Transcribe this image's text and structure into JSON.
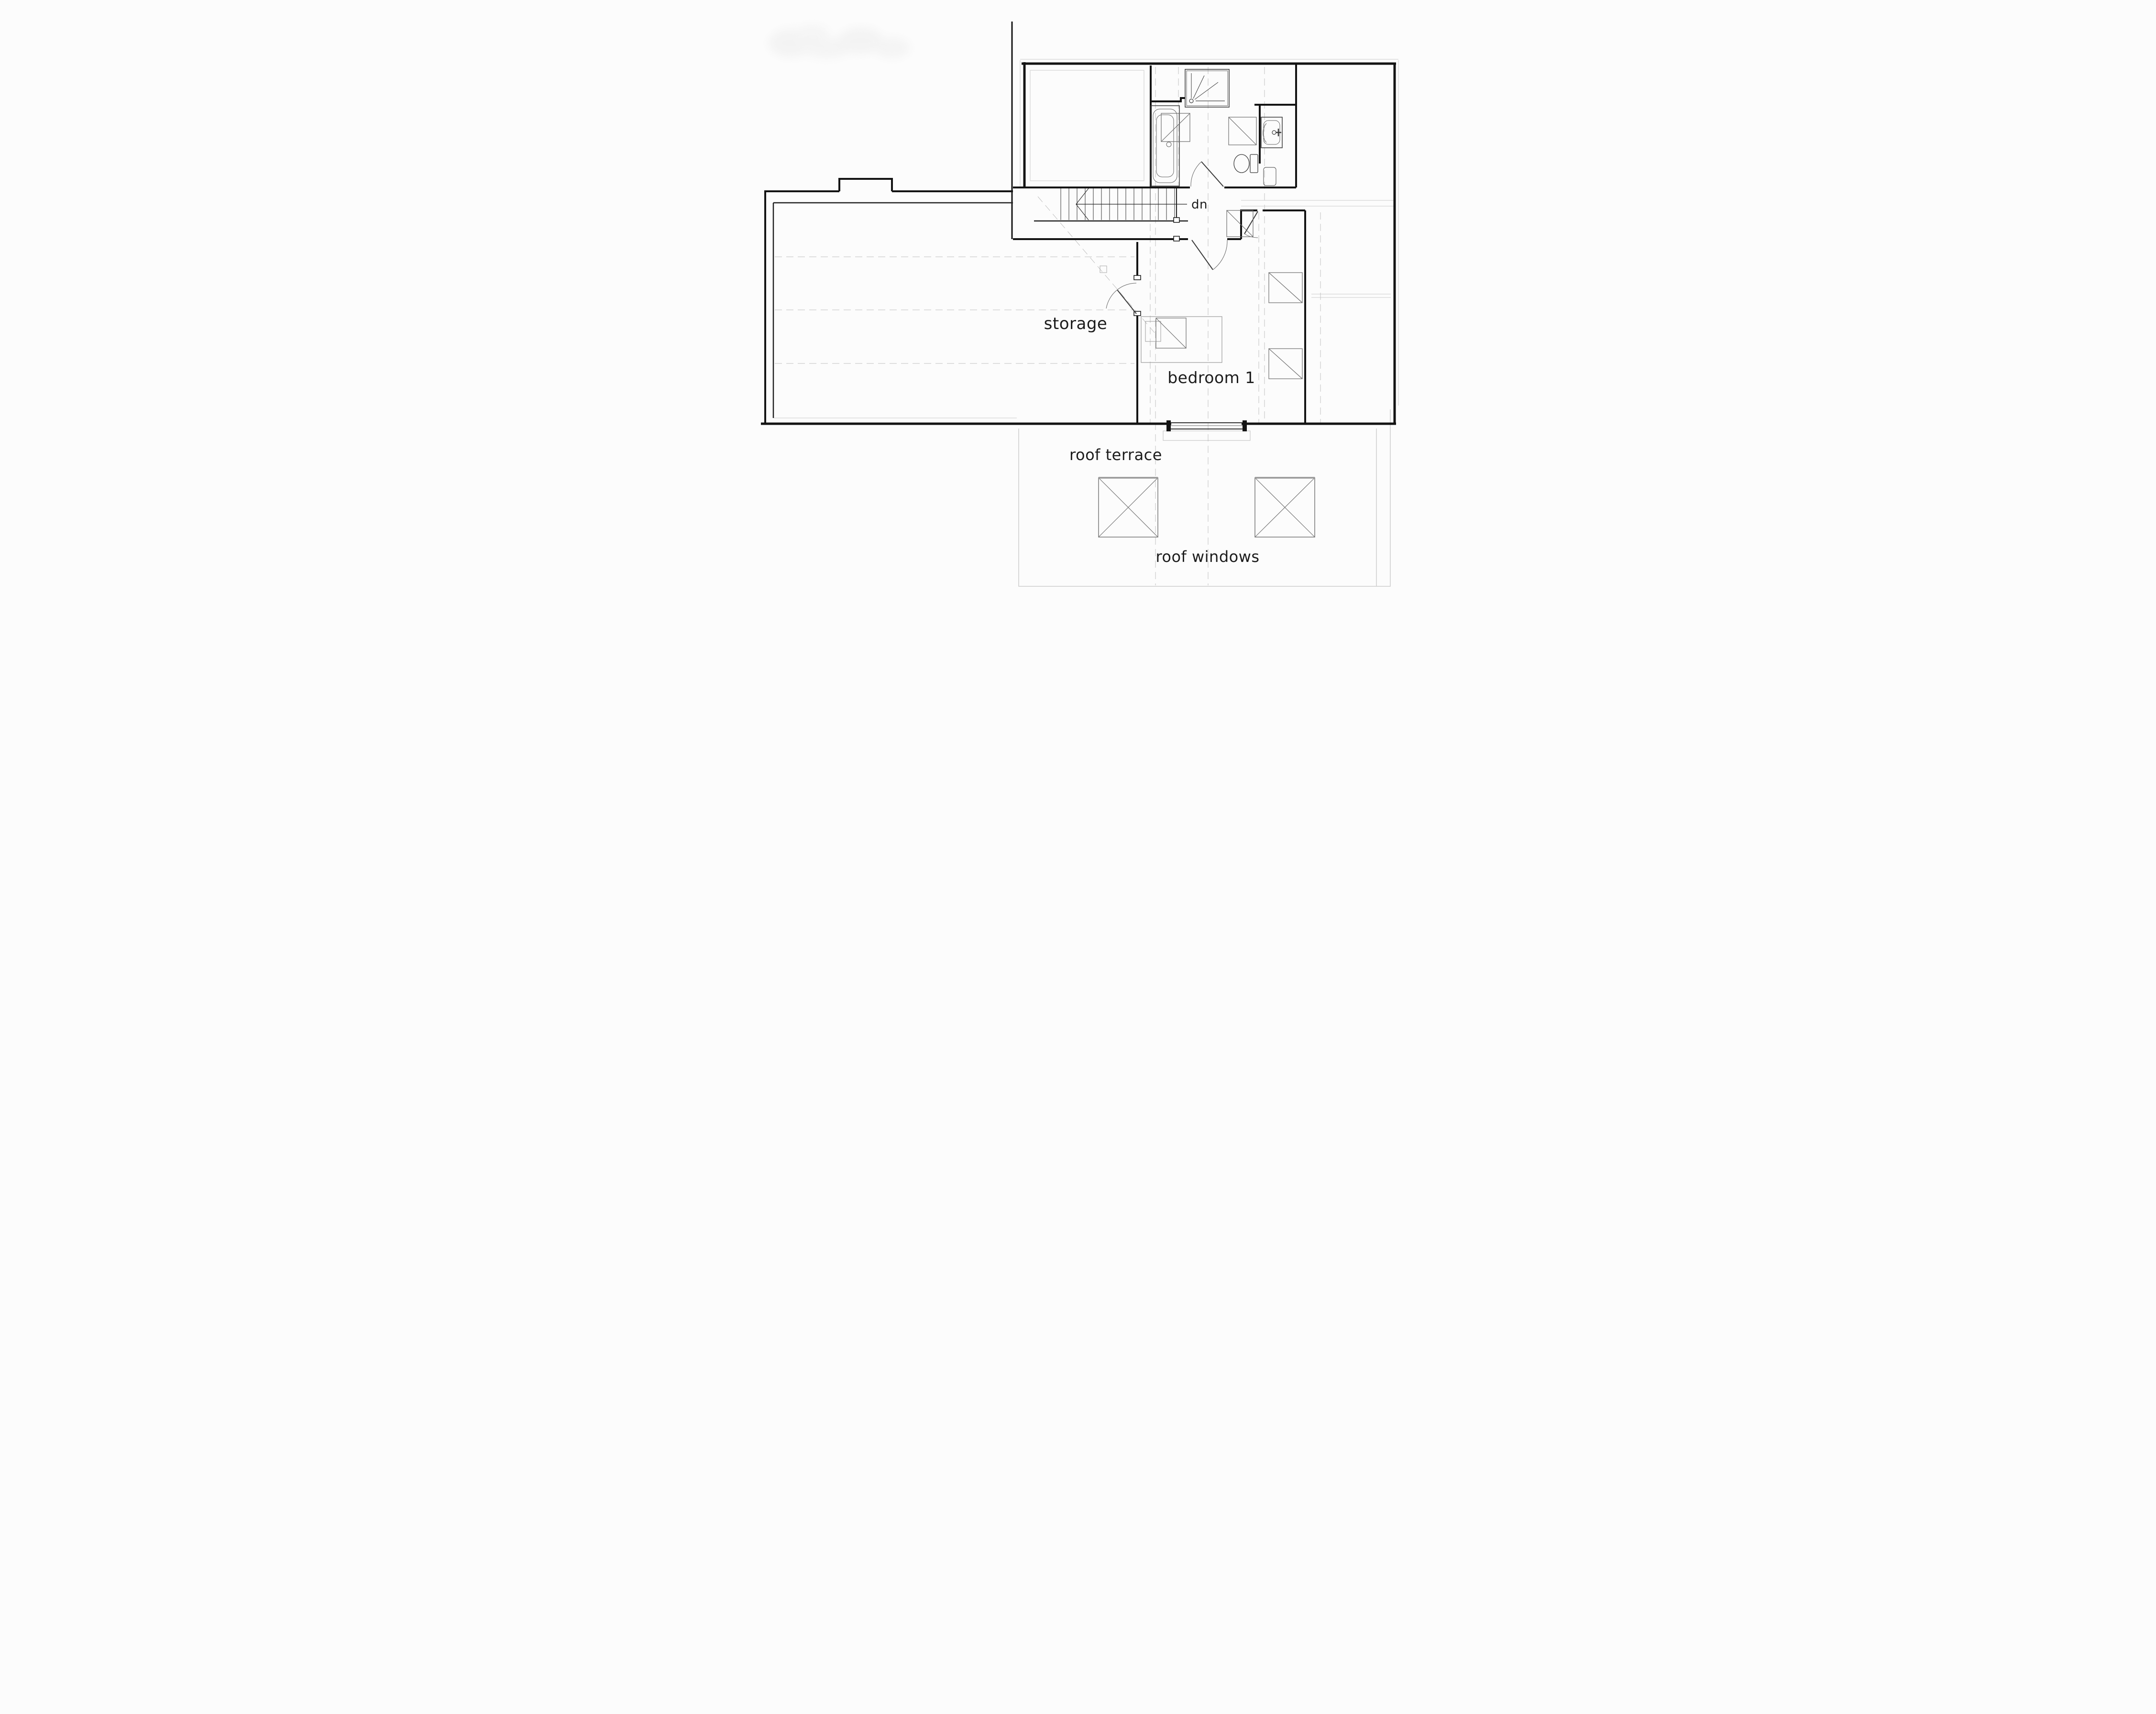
{
  "drawing": {
    "type": "architectural floor plan, CAD line drawing, attic / first-floor level",
    "background": "#fcfcfc"
  },
  "labels": {
    "storage": "storage",
    "bedroom": "bedroom 1",
    "roof_terrace": "roof terrace",
    "roof_windows": "roof windows",
    "stairs_direction": "dn"
  },
  "rooms": [
    {
      "name": "storage"
    },
    {
      "name": "bedroom 1"
    },
    {
      "name": "bathroom"
    },
    {
      "name": "landing"
    },
    {
      "name": "roof terrace"
    }
  ],
  "fixtures": [
    "bath-tub",
    "shower-tray",
    "toilet",
    "wash-basin",
    "bed",
    "staircase-down"
  ],
  "features": {
    "stair_treads": 14,
    "terrace_roof_windows": 2,
    "interior_roof_window_symbols": 6,
    "chimney_projection": true,
    "bedroom_window_to_terrace": true
  },
  "colors": {
    "wall": "#141414",
    "fixture": "#3a3a3a",
    "construction_line": "#bfbfbf",
    "text": "#1c1c1c",
    "background": "#fcfcfc"
  }
}
